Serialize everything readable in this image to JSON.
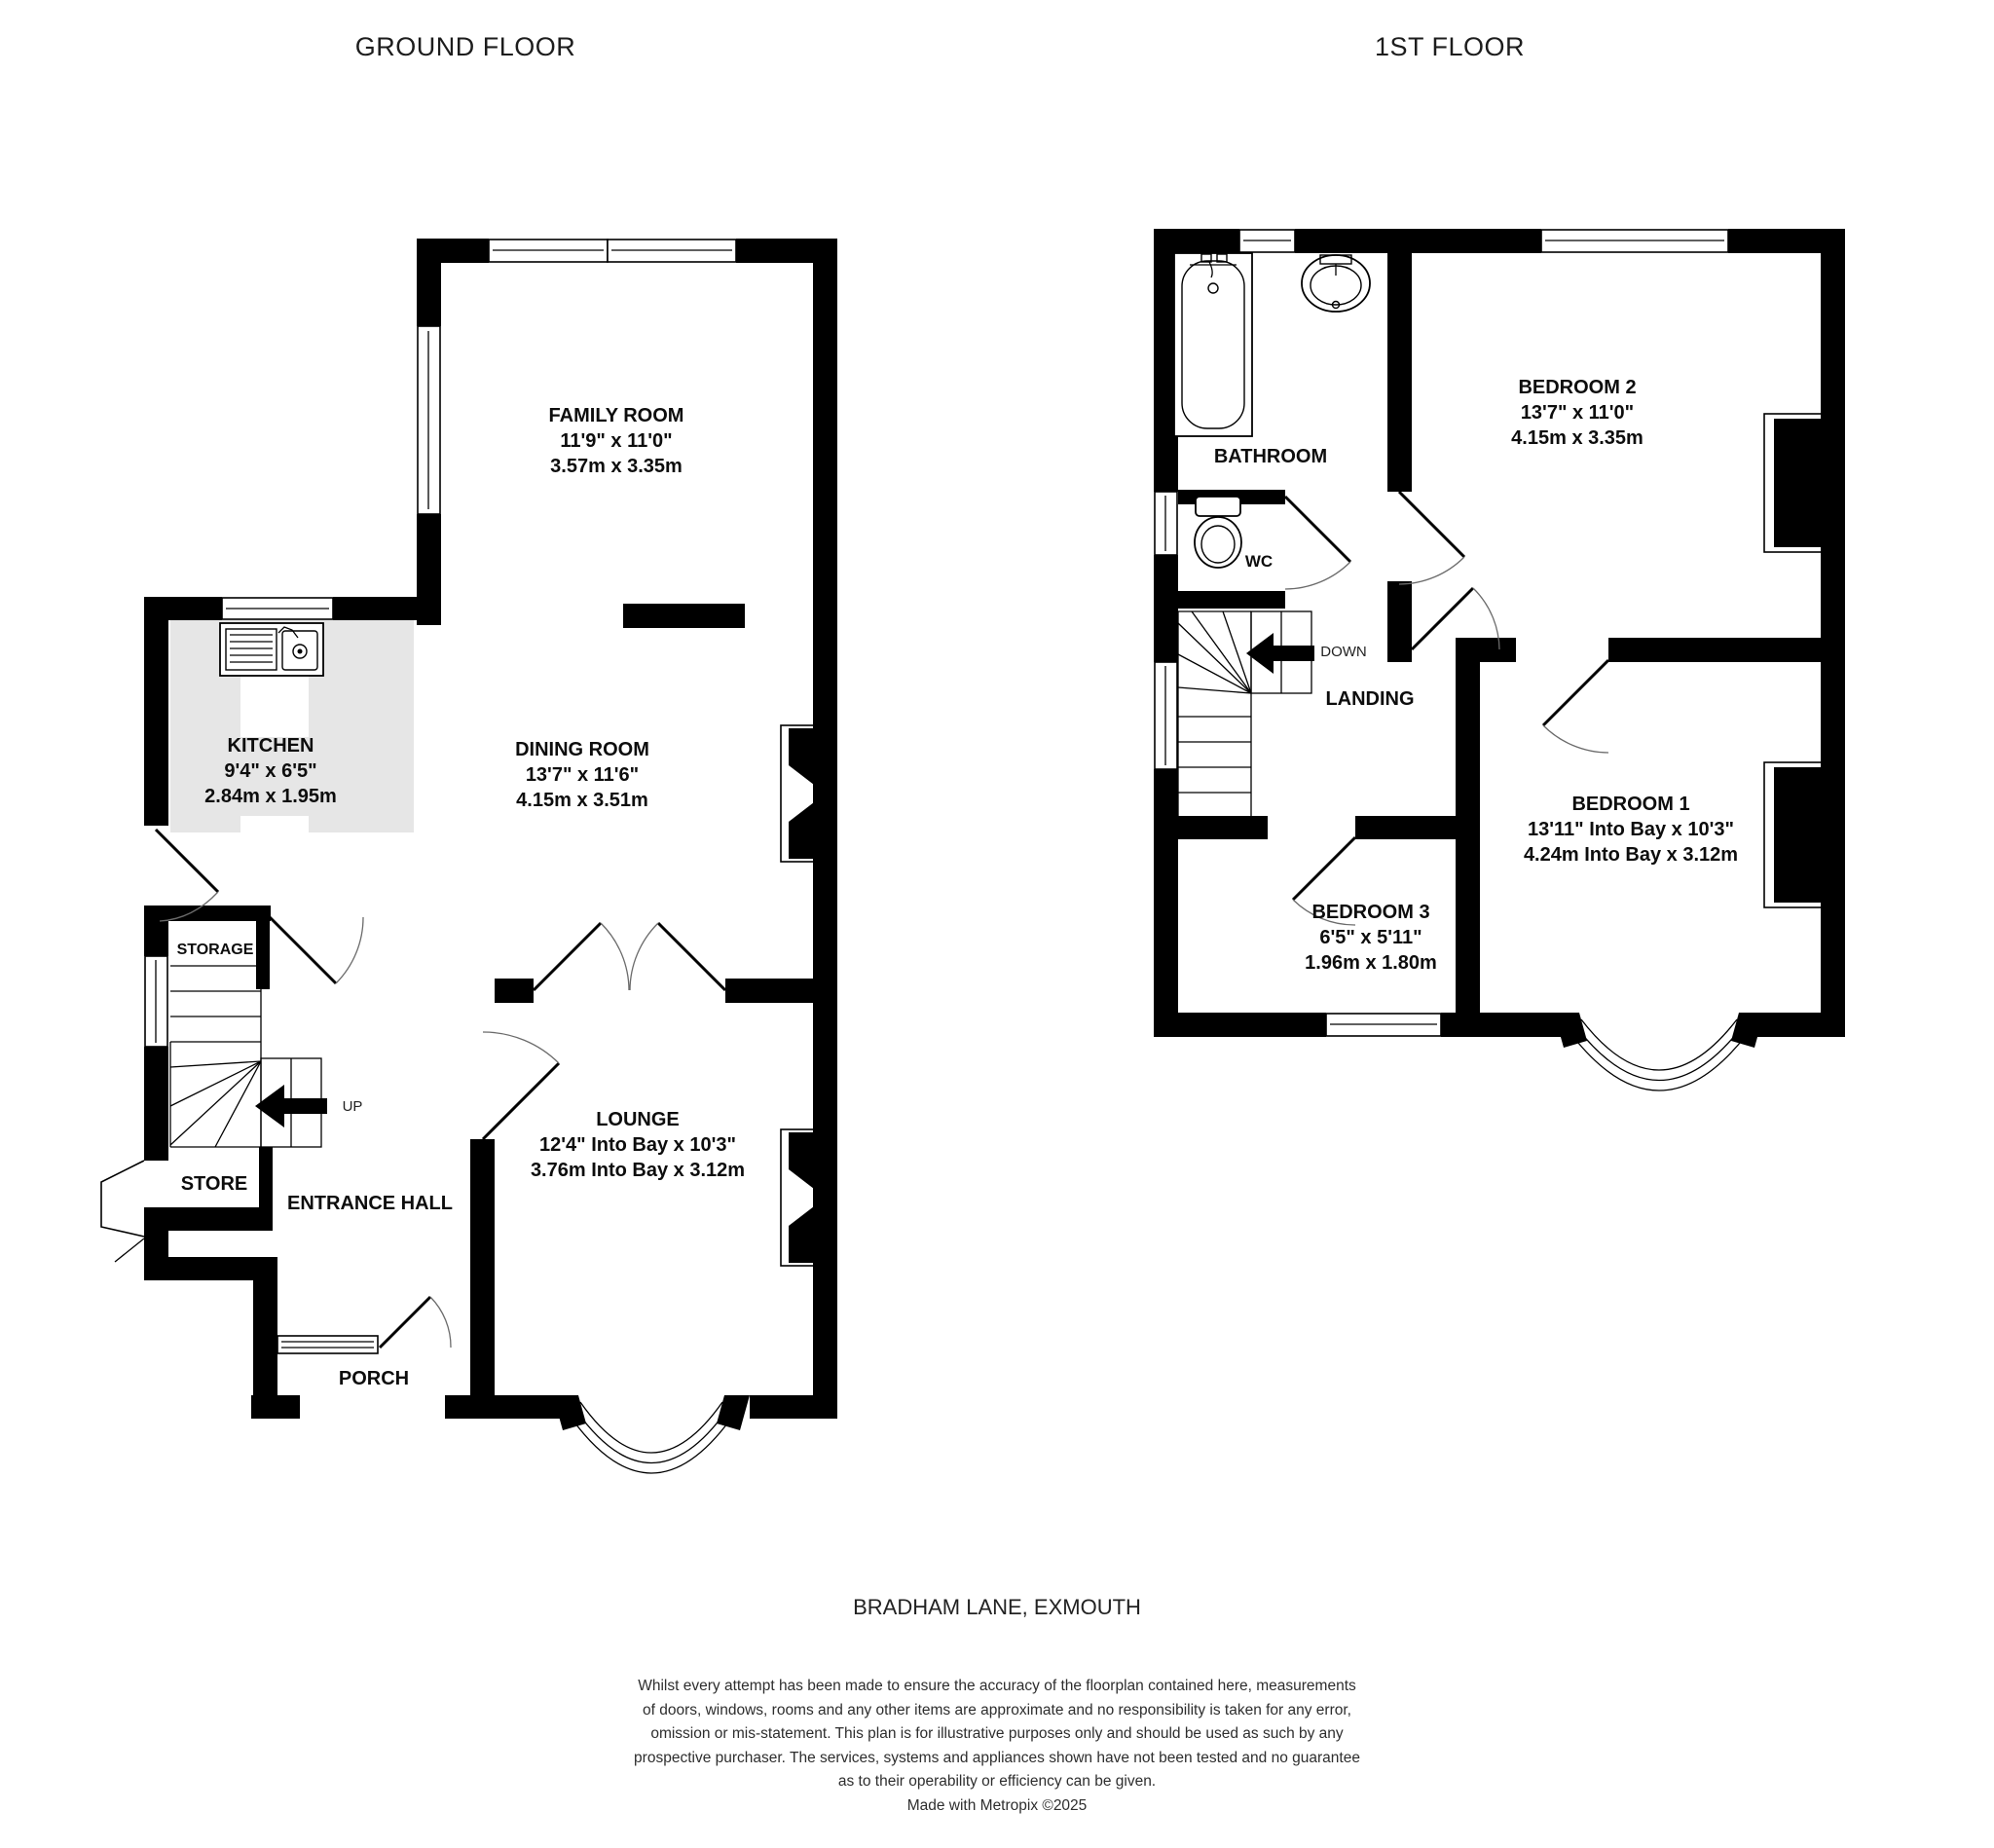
{
  "header": {
    "ground_title": "GROUND FLOOR",
    "first_title": "1ST FLOOR"
  },
  "ground": {
    "family_room": {
      "name": "FAMILY ROOM",
      "imperial": "11'9\"  x 11'0\"",
      "metric": "3.57m  x 3.35m"
    },
    "kitchen": {
      "name": "KITCHEN",
      "imperial": "9'4\"  x 6'5\"",
      "metric": "2.84m  x 1.95m"
    },
    "dining_room": {
      "name": "DINING ROOM",
      "imperial": "13'7\"  x 11'6\"",
      "metric": "4.15m  x 3.51m"
    },
    "lounge": {
      "name": "LOUNGE",
      "imperial": "12'4\" Into Bay x 10'3\"",
      "metric": "3.76m Into Bay x 3.12m"
    },
    "entrance_hall": {
      "name": "ENTRANCE HALL"
    },
    "porch": {
      "name": "PORCH"
    },
    "storage": {
      "name": "STORAGE"
    },
    "store": {
      "name": "STORE"
    },
    "stairs_label": "UP"
  },
  "first": {
    "bathroom": {
      "name": "BATHROOM"
    },
    "wc": {
      "name": "WC"
    },
    "bedroom2": {
      "name": "BEDROOM 2",
      "imperial": "13'7\"  x 11'0\"",
      "metric": "4.15m  x 3.35m"
    },
    "landing": {
      "name": "LANDING"
    },
    "stairs_label": "DOWN",
    "bedroom1": {
      "name": "BEDROOM 1",
      "imperial": "13'11\" Into Bay x 10'3\"",
      "metric": "4.24m Into Bay x 3.12m"
    },
    "bedroom3": {
      "name": "BEDROOM 3",
      "imperial": "6'5\"  x 5'11\"",
      "metric": "1.96m  x 1.80m"
    }
  },
  "footer": {
    "address": "BRADHAM LANE, EXMOUTH",
    "disclaimer_lines": [
      "Whilst every attempt has been made to ensure the accuracy of the floorplan contained here, measurements",
      "of doors, windows, rooms and any other items are approximate and no responsibility is taken for any error,",
      "omission or mis-statement. This plan is for illustrative purposes only and should be used as such by any",
      "prospective purchaser. The services, systems and appliances shown have not been tested and no guarantee",
      "as to their operability or efficiency can be given."
    ],
    "credit": "Made with Metropix ©2025"
  },
  "colors": {
    "wall": "#000000",
    "counter": "#e6e6e6",
    "background": "#ffffff"
  }
}
